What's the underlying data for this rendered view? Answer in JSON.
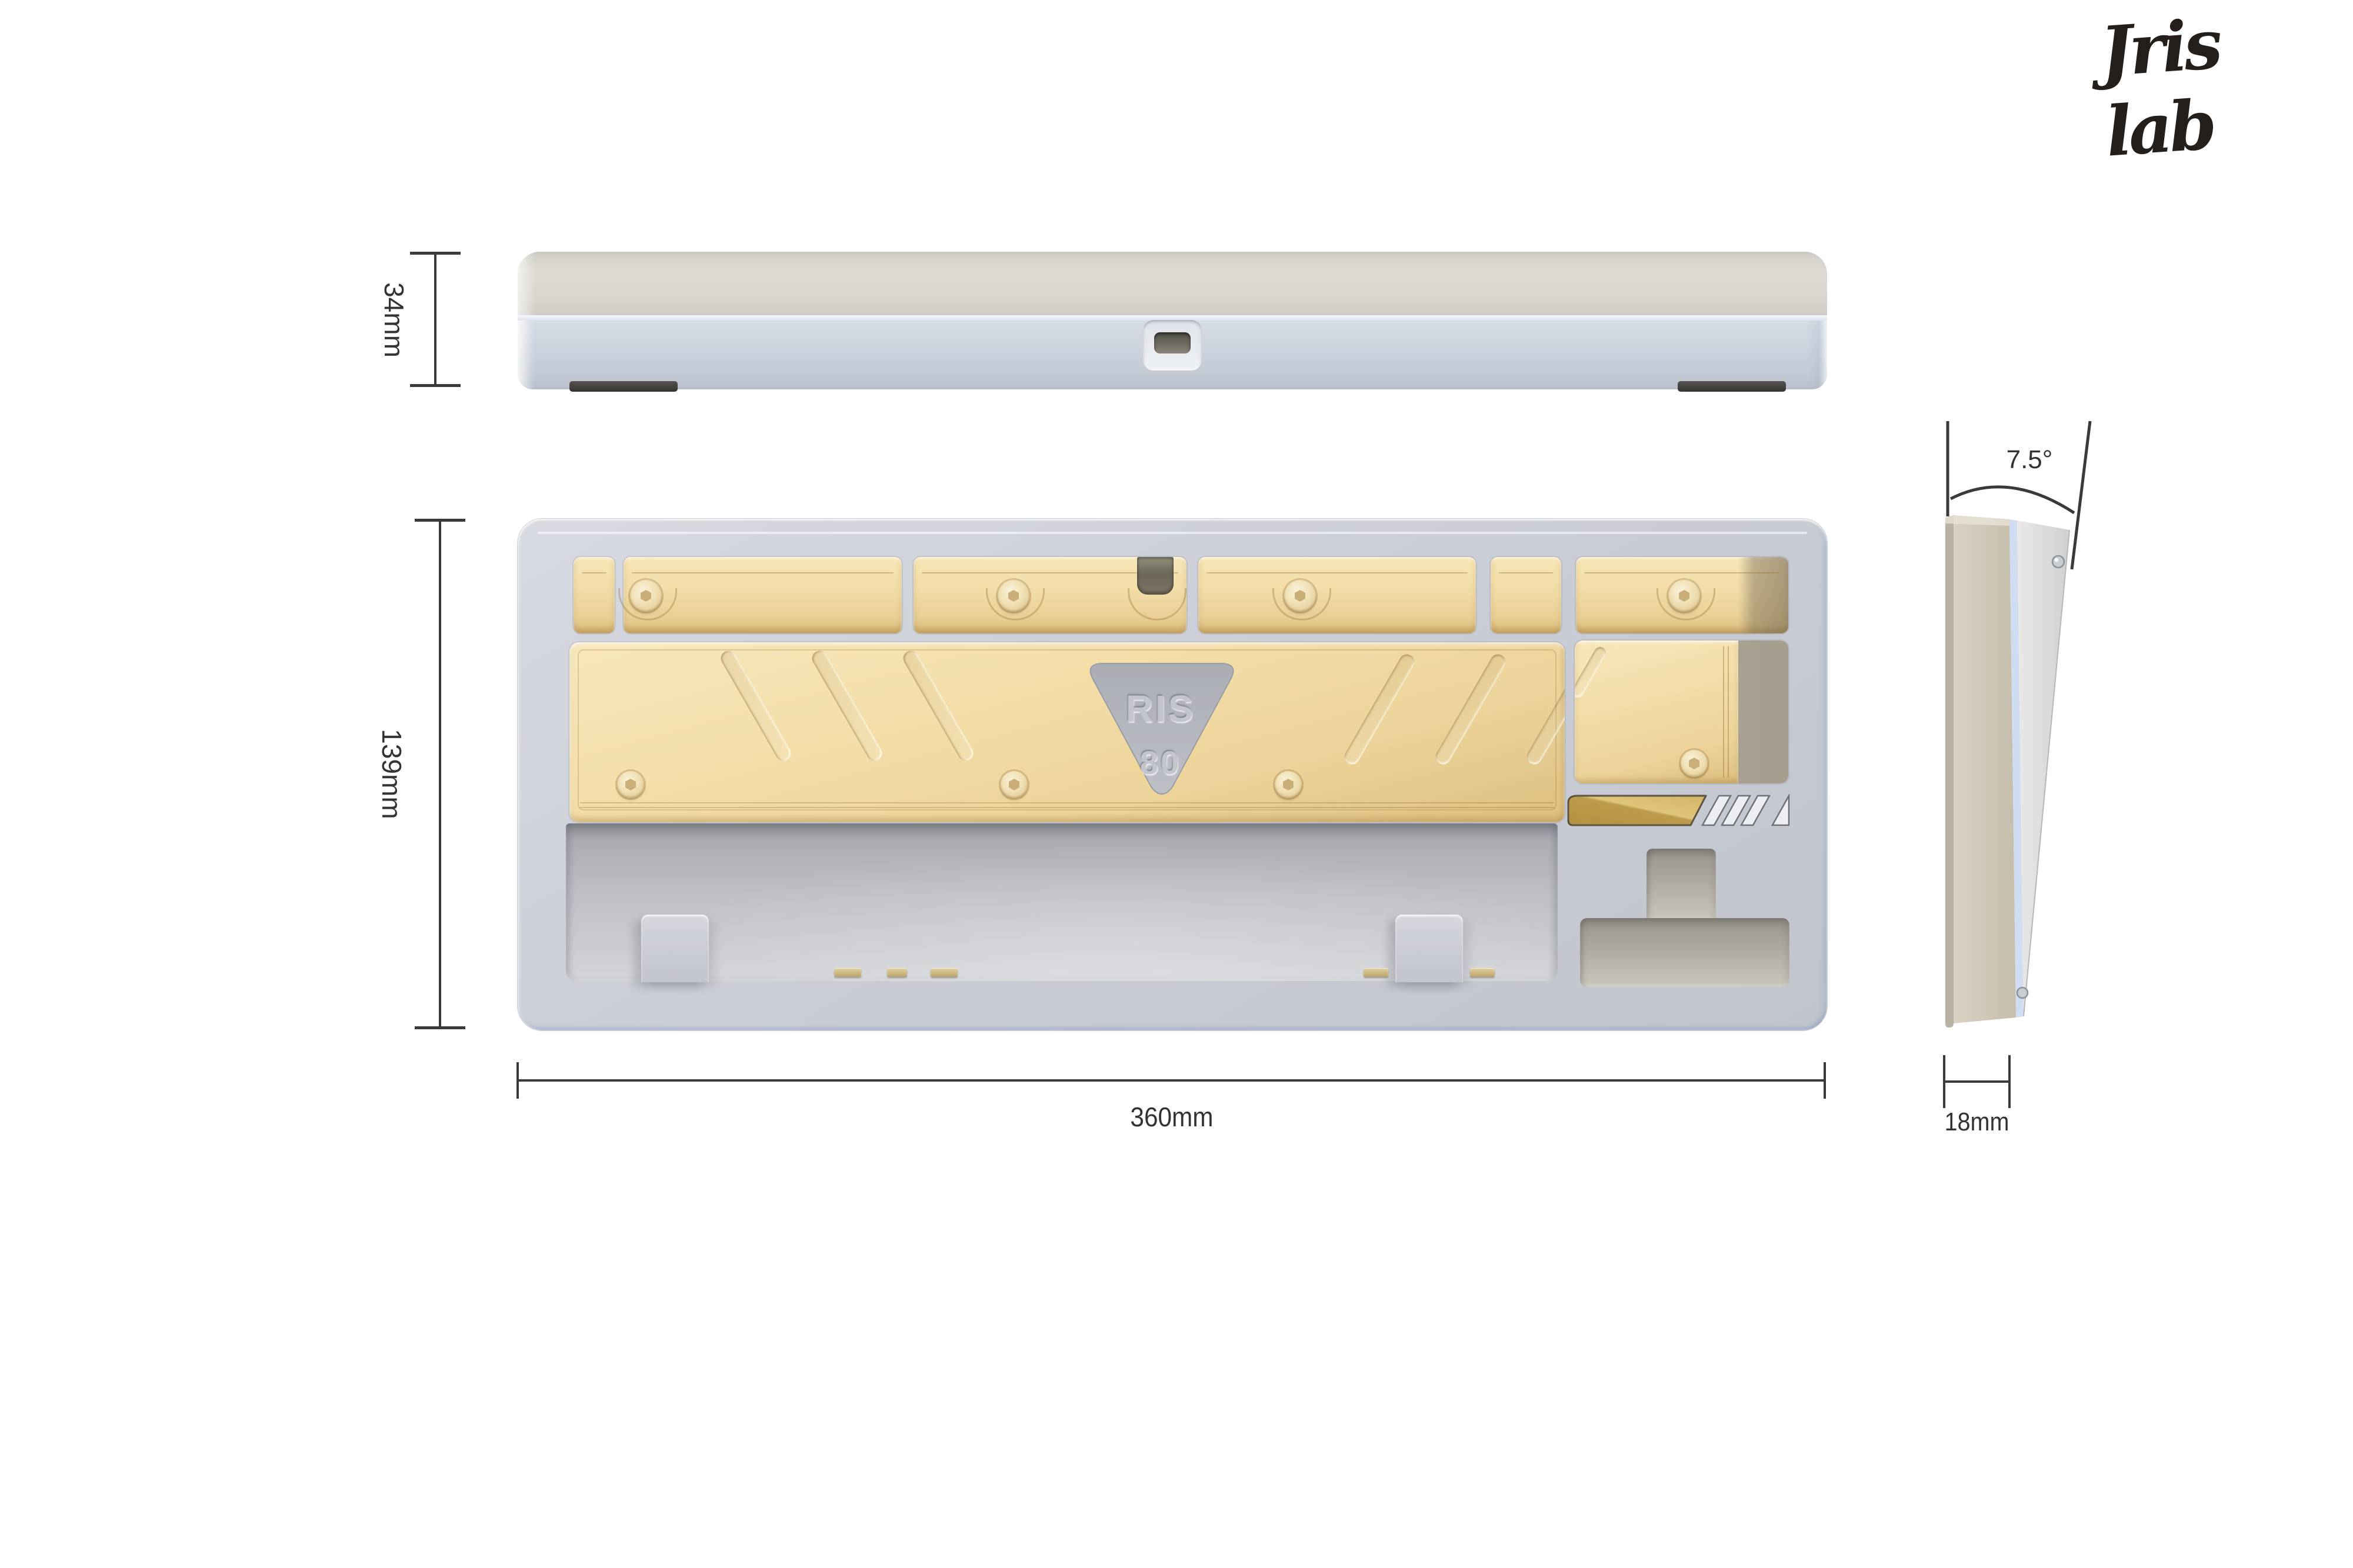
{
  "brand": {
    "logo_text": "Jris lab"
  },
  "plate_logo": {
    "line1": "RIS",
    "line2": "80"
  },
  "dimensions": {
    "case_height": "34mm",
    "case_depth": "139mm",
    "case_width": "360mm",
    "front_height": "18mm",
    "typing_angle": "7.5°"
  },
  "views": {
    "rear_elevation": "keyboard case rear view",
    "internal_top": "keyboard case internal top view",
    "side_profile": "keyboard case side profile"
  },
  "colors": {
    "case_gray": "#c9cdd5",
    "top_case_greige": "#dad6cf",
    "weight_gold": "#f2dca6",
    "badge_gold": "#c2a24f",
    "recess_gray": "#a8a49a",
    "annotation": "#3a3a3a"
  }
}
